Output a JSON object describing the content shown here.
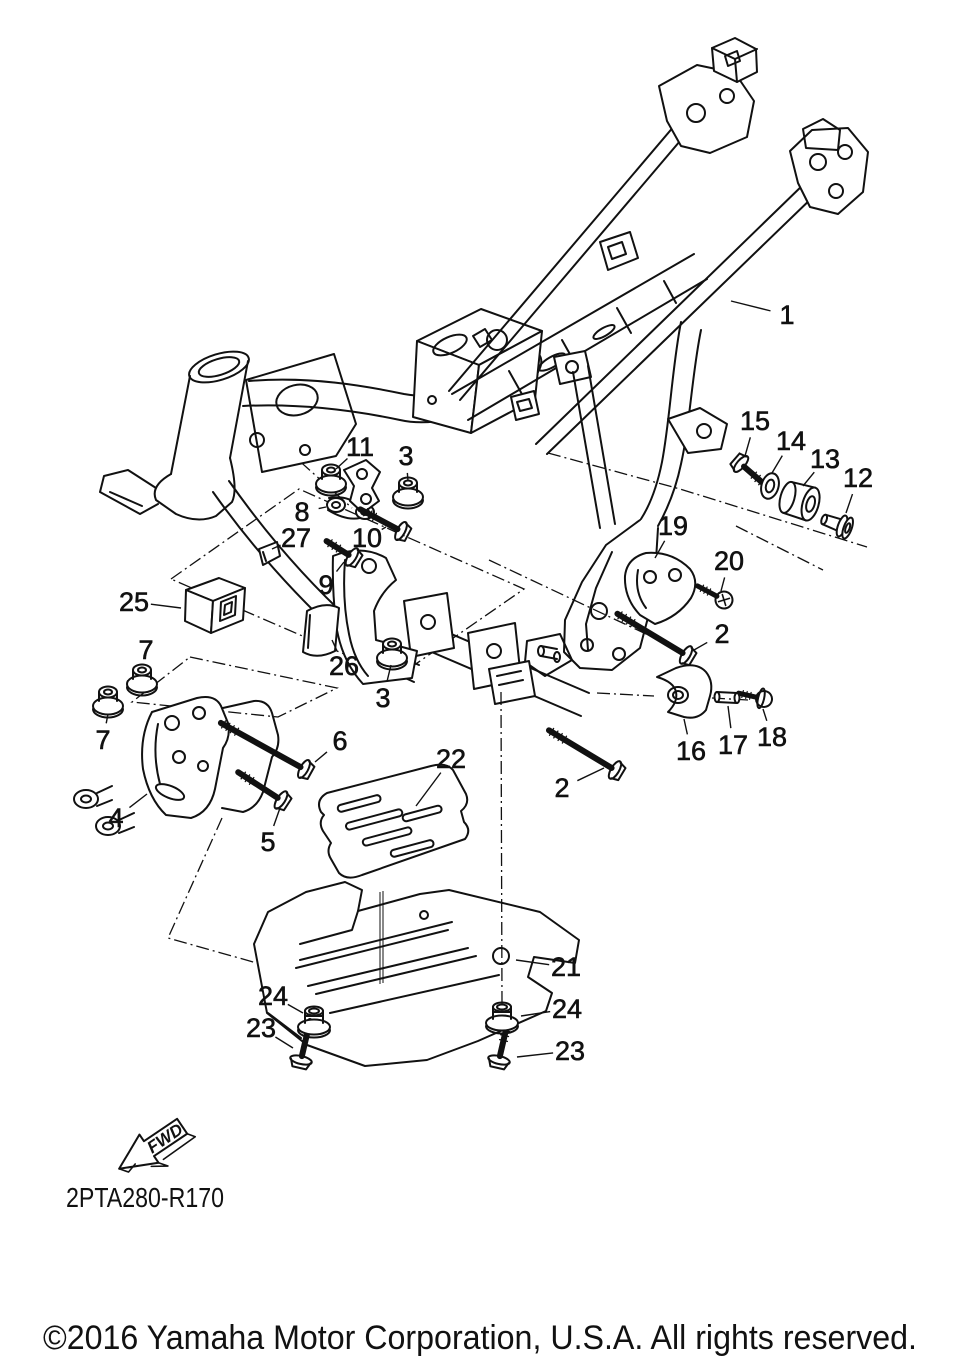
{
  "page": {
    "background_color": "#ffffff",
    "line_color": "#111111"
  },
  "diagram": {
    "title_code": "2PTA280-R170",
    "fwd_label": "FWD",
    "copyright": "©2016 Yamaha Motor Corporation, U.S.A. All rights reserved."
  },
  "callouts": [
    {
      "label": "1",
      "x": 787,
      "y": 315,
      "tx": 731,
      "ty": 301
    },
    {
      "label": "15",
      "x": 755,
      "y": 421,
      "tx": 745,
      "ty": 456
    },
    {
      "label": "14",
      "x": 791,
      "y": 441,
      "tx": 772,
      "ty": 473
    },
    {
      "label": "13",
      "x": 825,
      "y": 459,
      "tx": 803,
      "ty": 486
    },
    {
      "label": "12",
      "x": 858,
      "y": 478,
      "tx": 846,
      "ty": 513
    },
    {
      "label": "11",
      "x": 360,
      "y": 447,
      "tx": 336,
      "ty": 469
    },
    {
      "label": "3",
      "x": 406,
      "y": 456,
      "tx": 408,
      "ty": 481
    },
    {
      "label": "8",
      "x": 302,
      "y": 512,
      "tx": 326,
      "ty": 507
    },
    {
      "label": "27",
      "x": 296,
      "y": 538,
      "tx": 272,
      "ty": 549
    },
    {
      "label": "10",
      "x": 367,
      "y": 538,
      "tx": 386,
      "ty": 527
    },
    {
      "label": "9",
      "x": 326,
      "y": 585,
      "tx": 344,
      "ty": 562
    },
    {
      "label": "19",
      "x": 673,
      "y": 526,
      "tx": 655,
      "ty": 558
    },
    {
      "label": "20",
      "x": 729,
      "y": 561,
      "tx": 721,
      "ty": 591
    },
    {
      "label": "2",
      "x": 722,
      "y": 634,
      "tx": 694,
      "ty": 650
    },
    {
      "label": "25",
      "x": 134,
      "y": 602,
      "tx": 181,
      "ty": 608
    },
    {
      "label": "7",
      "x": 146,
      "y": 650,
      "tx": 142,
      "ty": 667
    },
    {
      "label": "7",
      "x": 103,
      "y": 740,
      "tx": 108,
      "ty": 714
    },
    {
      "label": "26",
      "x": 344,
      "y": 666,
      "tx": 332,
      "ty": 640
    },
    {
      "label": "3",
      "x": 383,
      "y": 698,
      "tx": 391,
      "ty": 665
    },
    {
      "label": "16",
      "x": 691,
      "y": 751,
      "tx": 684,
      "ty": 719
    },
    {
      "label": "17",
      "x": 733,
      "y": 745,
      "tx": 728,
      "ty": 706
    },
    {
      "label": "18",
      "x": 772,
      "y": 737,
      "tx": 763,
      "ty": 709
    },
    {
      "label": "6",
      "x": 340,
      "y": 741,
      "tx": 315,
      "ty": 762
    },
    {
      "label": "4",
      "x": 116,
      "y": 818,
      "tx": 147,
      "ty": 794
    },
    {
      "label": "5",
      "x": 268,
      "y": 842,
      "tx": 280,
      "ty": 808
    },
    {
      "label": "22",
      "x": 451,
      "y": 759,
      "tx": 416,
      "ty": 806
    },
    {
      "label": "2",
      "x": 562,
      "y": 788,
      "tx": 604,
      "ty": 768
    },
    {
      "label": "21",
      "x": 566,
      "y": 967,
      "tx": 516,
      "ty": 960
    },
    {
      "label": "24",
      "x": 273,
      "y": 996,
      "tx": 303,
      "ty": 1013
    },
    {
      "label": "23",
      "x": 261,
      "y": 1028,
      "tx": 293,
      "ty": 1048
    },
    {
      "label": "24",
      "x": 567,
      "y": 1009,
      "tx": 521,
      "ty": 1016
    },
    {
      "label": "23",
      "x": 570,
      "y": 1051,
      "tx": 517,
      "ty": 1057
    }
  ]
}
